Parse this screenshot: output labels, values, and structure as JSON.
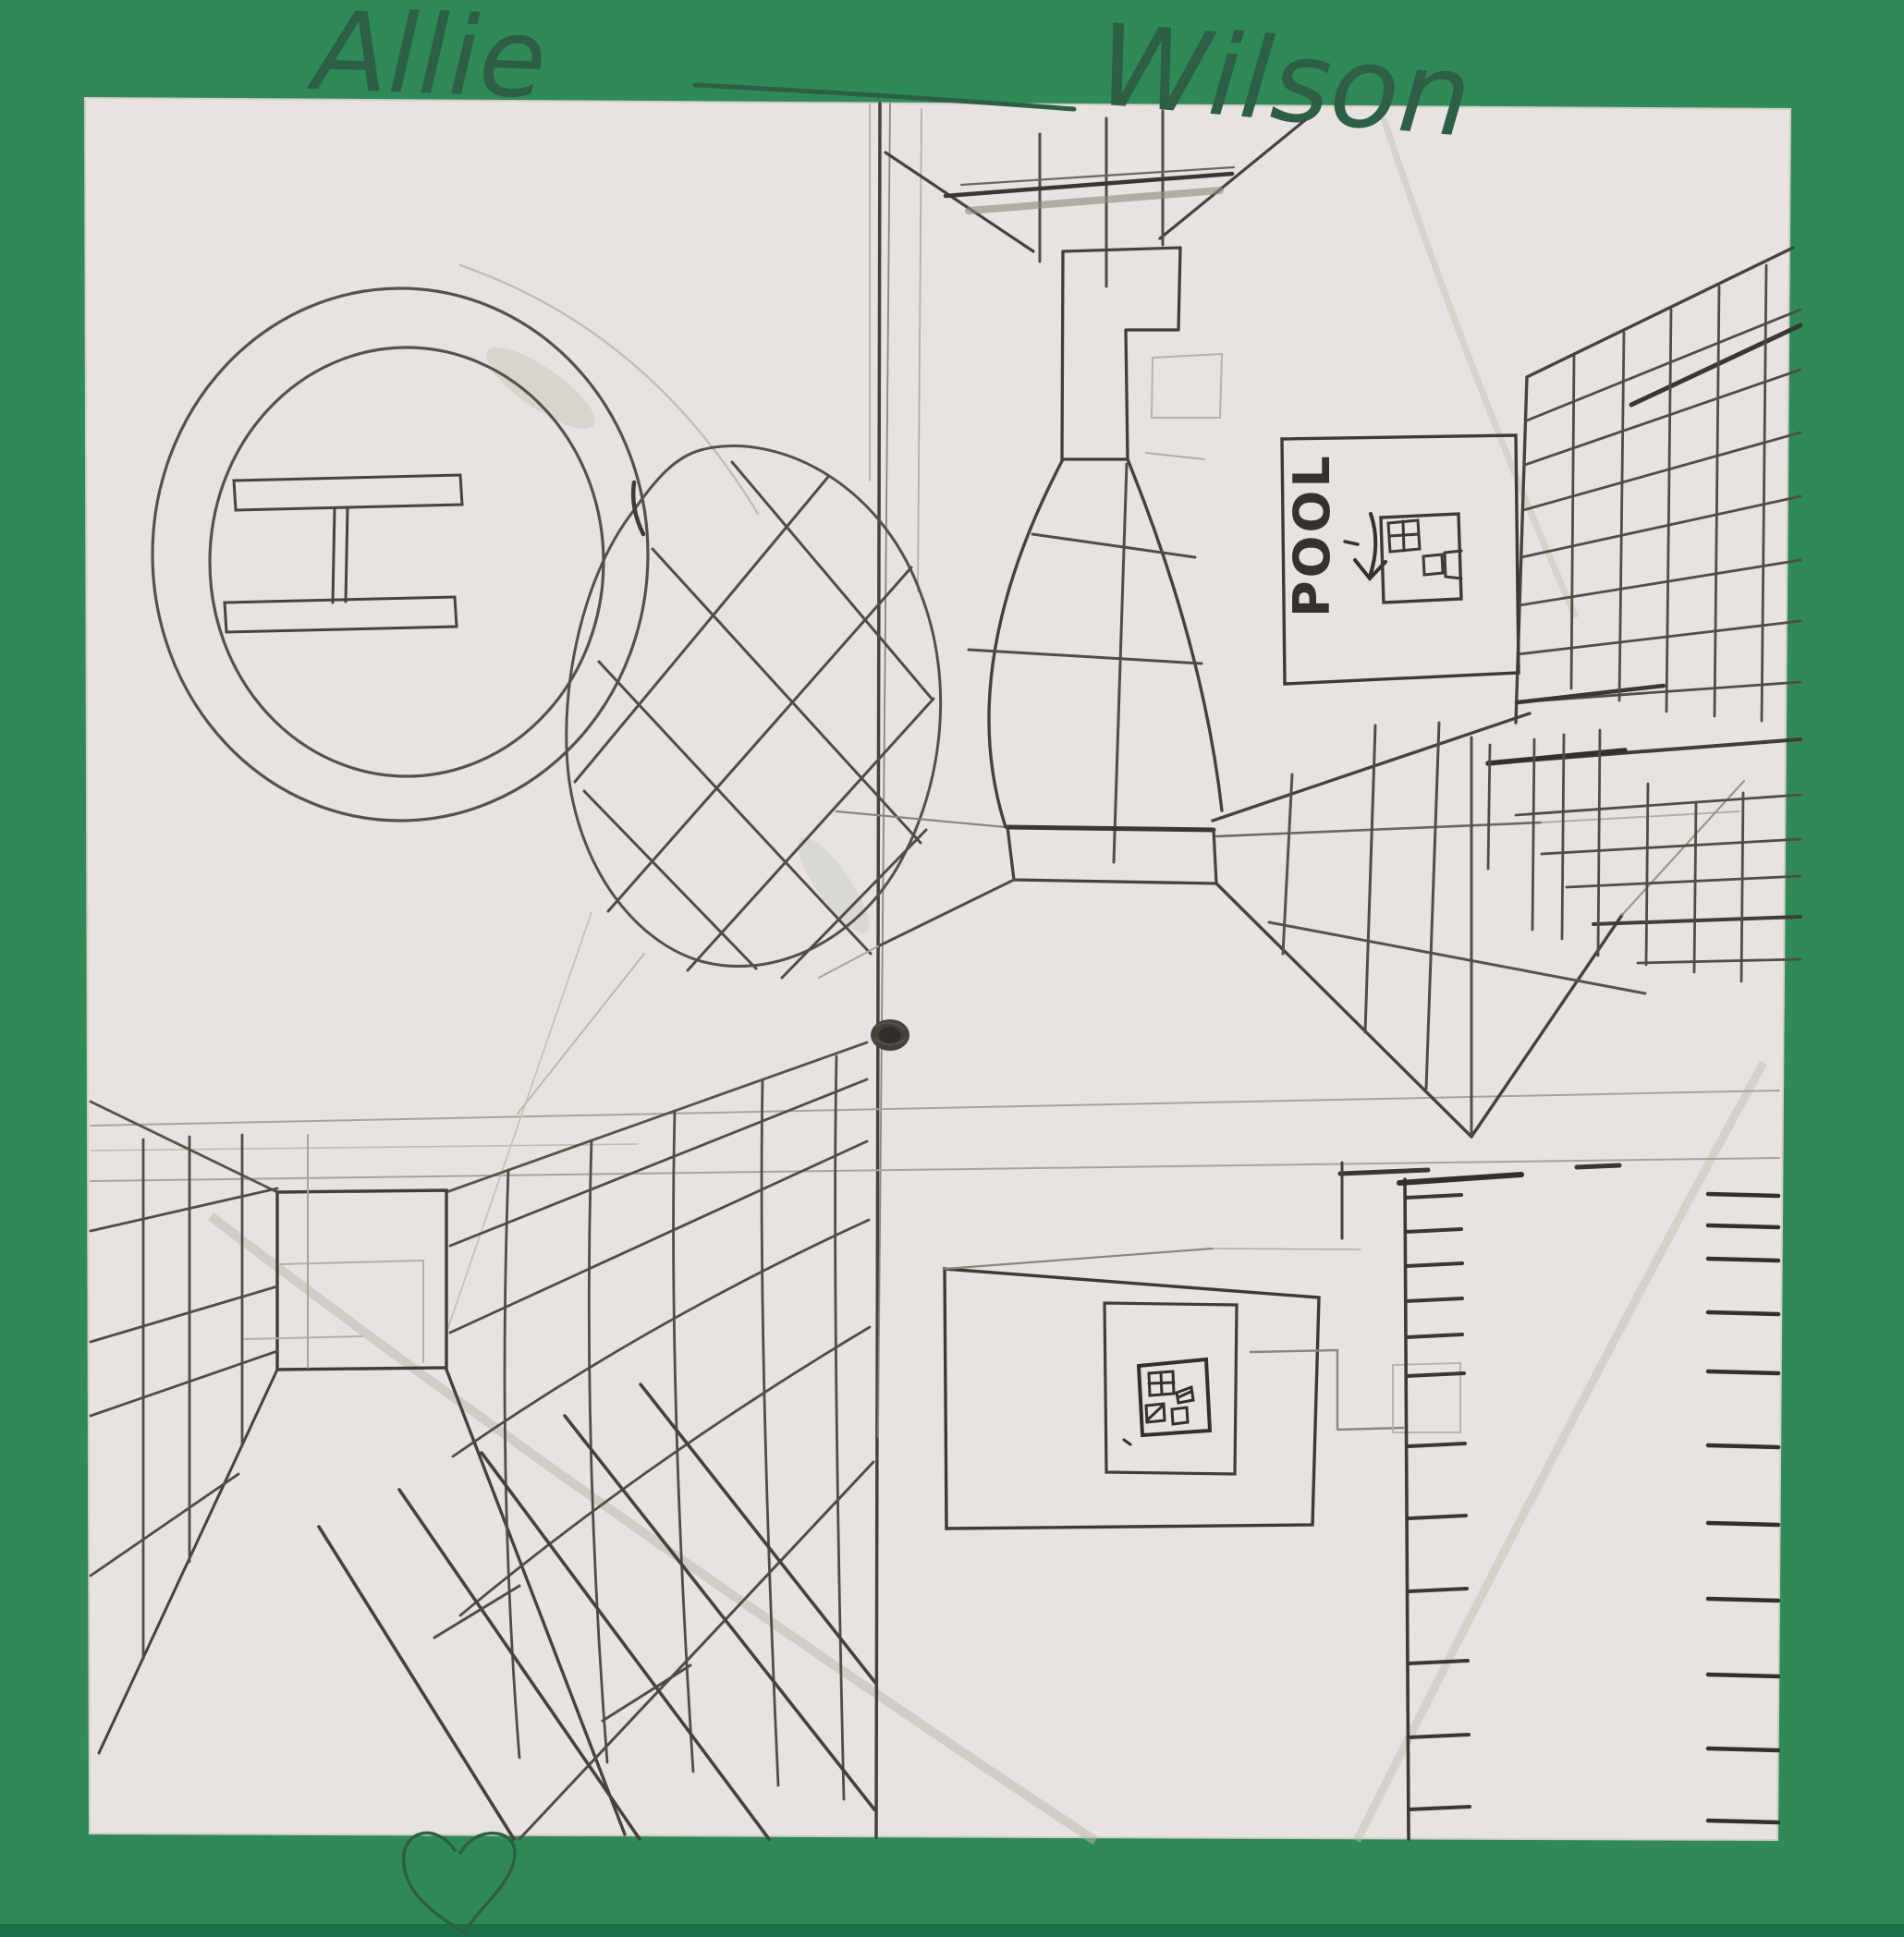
{
  "artwork": {
    "signature": {
      "first_name": "Allie",
      "last_name": "Wilson"
    },
    "pool_sign": {
      "label": "POOL"
    },
    "colors": {
      "mat_green": "#2f8a57",
      "mat_green_shadow": "#1b7048",
      "paper": "#e7e4df",
      "pencil_dark": "#3a3733",
      "pencil_mid": "#6b675f",
      "pencil_faint": "#aeaaa1",
      "pencil_on_green": "#2d5f46"
    },
    "icons": {
      "heart": "heart-icon",
      "vanishing_point": "vanishing-point-dot"
    }
  }
}
